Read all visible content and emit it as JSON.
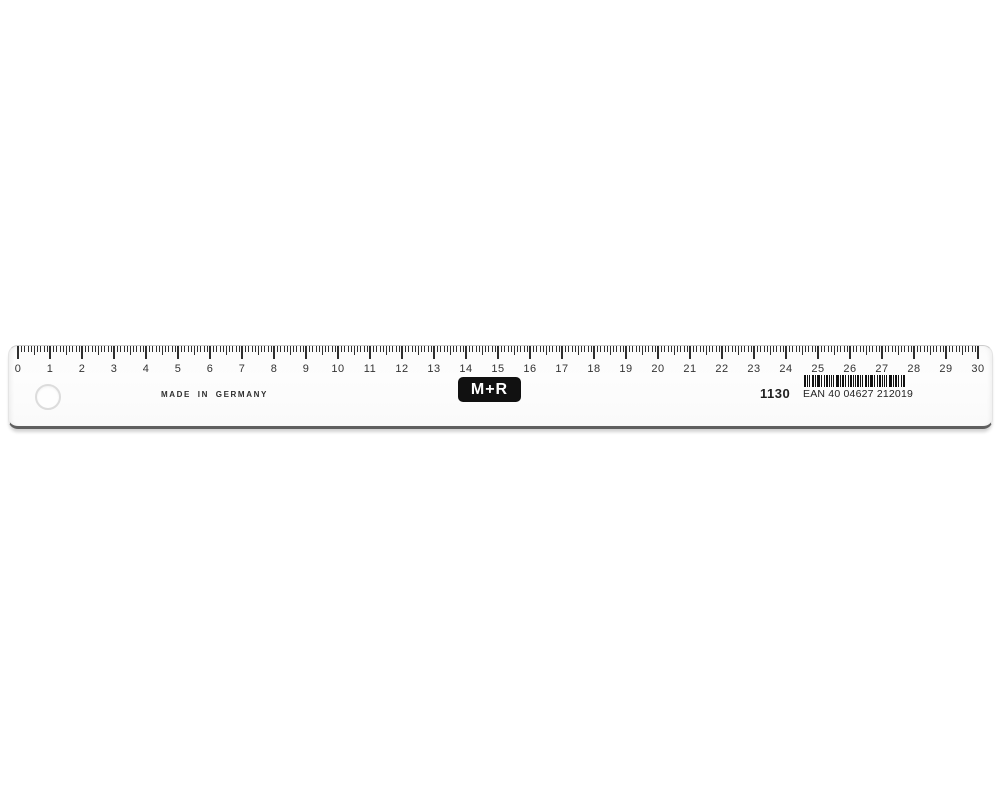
{
  "ruler": {
    "made_in_label": "MADE IN GERMANY",
    "brand_logo": "M+R",
    "model_number": "1130",
    "ean_label": "EAN 40 04627 212019",
    "scale": {
      "min": 0,
      "max": 30,
      "minor_per_major": 10,
      "numbers": [
        "0",
        "1",
        "2",
        "3",
        "4",
        "5",
        "6",
        "7",
        "8",
        "9",
        "10",
        "11",
        "12",
        "13",
        "14",
        "15",
        "16",
        "17",
        "18",
        "19",
        "20",
        "21",
        "22",
        "23",
        "24",
        "25",
        "26",
        "27",
        "28",
        "29",
        "30"
      ]
    },
    "colors": {
      "tick": "#2f2f2f",
      "number": "#333333",
      "logo_bg": "#111111",
      "logo_text": "#ffffff",
      "body": "#fbfbfb",
      "bottom_bevel": "#5f5f5f"
    }
  }
}
